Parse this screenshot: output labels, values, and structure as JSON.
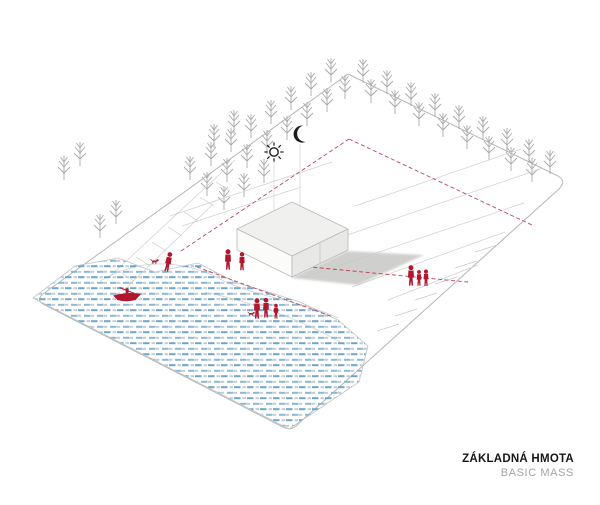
{
  "caption": {
    "title": "ZÁKLADNÁ HMOTA",
    "subtitle": "BASIC MASS"
  },
  "colors": {
    "red_figure": "#b1162f",
    "red_line": "#c2435a",
    "tree": "#a9a9a9",
    "boundary": "#b6b6b6",
    "ground": "#cfcfcf",
    "tick": "#c9c9c9",
    "water_blue": "#6fa6c6",
    "water_blue2": "#8ab8d2",
    "water_gray": "#c3ccd2",
    "water_edge": "#bdc6cc",
    "shadow": "#c7c7c6",
    "face_top": "#f0f0ef",
    "face_left": "#fbfbfa",
    "face_right": "#e8e8e7",
    "edge_face": "#b9b9b7",
    "guide": "#d8d8d8",
    "icon_dark": "#1d1d1d",
    "title": "#161616",
    "subtitle": "#a3a3a3"
  },
  "icons": {
    "sun": {
      "name": "sun-icon",
      "x": 274,
      "y": 152
    },
    "moon": {
      "name": "moon-icon",
      "x": 299,
      "y": 134
    }
  },
  "scene": {
    "site_outline_path": "M348 74 L558 176 Q567 181 559 189 L296 426 Q290 431 283 427 L43 304 Q36 300 43 294 Z",
    "trees": [
      [
        190,
        180
      ],
      [
        211,
        166
      ],
      [
        231,
        152
      ],
      [
        251,
        138
      ],
      [
        271,
        124
      ],
      [
        291,
        110
      ],
      [
        311,
        96
      ],
      [
        331,
        82
      ],
      [
        207,
        196
      ],
      [
        227,
        182
      ],
      [
        247,
        168
      ],
      [
        267,
        154
      ],
      [
        287,
        140
      ],
      [
        307,
        126
      ],
      [
        327,
        112
      ],
      [
        345,
        99
      ],
      [
        224,
        210
      ],
      [
        244,
        197
      ],
      [
        264,
        183
      ],
      [
        214,
        148
      ],
      [
        234,
        134
      ],
      [
        64,
        180
      ],
      [
        80,
        166
      ],
      [
        100,
        238
      ],
      [
        116,
        224
      ],
      [
        363,
        83
      ],
      [
        387,
        94
      ],
      [
        411,
        106
      ],
      [
        435,
        117
      ],
      [
        459,
        129
      ],
      [
        483,
        140
      ],
      [
        507,
        152
      ],
      [
        529,
        163
      ],
      [
        550,
        174
      ],
      [
        371,
        103
      ],
      [
        395,
        114
      ],
      [
        419,
        126
      ],
      [
        443,
        137
      ],
      [
        467,
        149
      ],
      [
        489,
        160
      ],
      [
        511,
        171
      ],
      [
        532,
        182
      ]
    ],
    "ground_lines": [
      "M108 278 L235 160",
      "M123 291 L212 205",
      "M170 216 L332 162",
      "M182 226 L301 187",
      "M355 206 L521 149",
      "M330 241 L543 168",
      "M305 277 L524 203",
      "M352 287 L505 232",
      "M388 300 L478 265",
      "M100 281 C140 258 182 258 226 282",
      "M226 282 C262 298 305 302 338 318",
      "M205 292 C250 302 300 318 345 345"
    ],
    "hatch_ticks": [
      "M120 272 L134 281",
      "M136 257 L150 266",
      "M152 242 L166 251",
      "M168 227 L182 236",
      "M184 212 L198 221",
      "M200 197 L214 206",
      "M216 182 L230 191",
      "M475 252 L497 245",
      "M455 268 L477 261",
      "M435 284 L457 277",
      "M415 300 L437 293",
      "M395 316 L417 309",
      "M377 331 L399 324"
    ],
    "red_dashed_lines_back": [
      "M181 251 L349 139",
      "M349 139 L532 225",
      "M197 267 L333 317"
    ],
    "red_dashed_line_front": "M300 266 L468 282",
    "guide_lines": [
      "M274 159 L274 220",
      "M300 144 L300 218"
    ],
    "water": {
      "outline": "33,298 75,266 118,258 155,272 198,263 237,283 262,290 300,302 338,320 368,346 359,382 289,429",
      "boat": {
        "x": 127,
        "y": 296
      }
    },
    "building": {
      "top": "237,229 292,202 348,229 292,256",
      "left_face": "237,229 292,256 292,277 237,250",
      "right_face": "292,256 348,229 348,250 292,277",
      "seam": "M320 242.5 L320 263.5",
      "shadow": "291,278 347,251 424,255 358,285"
    },
    "people_groups": [
      {
        "name": "walker-with-dog",
        "figures": [
          {
            "type": "dog",
            "x": 152,
            "y": 264,
            "s": 1
          },
          {
            "type": "person",
            "x": 167,
            "y": 268,
            "s": 1.25,
            "r": 12
          }
        ]
      },
      {
        "name": "pair-standing",
        "figures": [
          {
            "type": "person",
            "x": 228,
            "y": 266,
            "s": 1.3
          },
          {
            "type": "person",
            "x": 242,
            "y": 267,
            "s": 1.15
          }
        ]
      },
      {
        "name": "family-by-water",
        "figures": [
          {
            "type": "dog",
            "x": 249,
            "y": 316,
            "s": 0.85
          },
          {
            "type": "person",
            "x": 257,
            "y": 315,
            "s": 1.3
          },
          {
            "type": "person",
            "x": 266,
            "y": 314,
            "s": 1.25
          },
          {
            "type": "person",
            "x": 276,
            "y": 316,
            "s": 0.95
          }
        ]
      },
      {
        "name": "trio-east",
        "figures": [
          {
            "type": "person",
            "x": 411,
            "y": 282,
            "s": 1.3
          },
          {
            "type": "person",
            "x": 419,
            "y": 283,
            "s": 1.0
          },
          {
            "type": "person",
            "x": 426,
            "y": 283,
            "s": 1.05
          }
        ]
      }
    ]
  }
}
